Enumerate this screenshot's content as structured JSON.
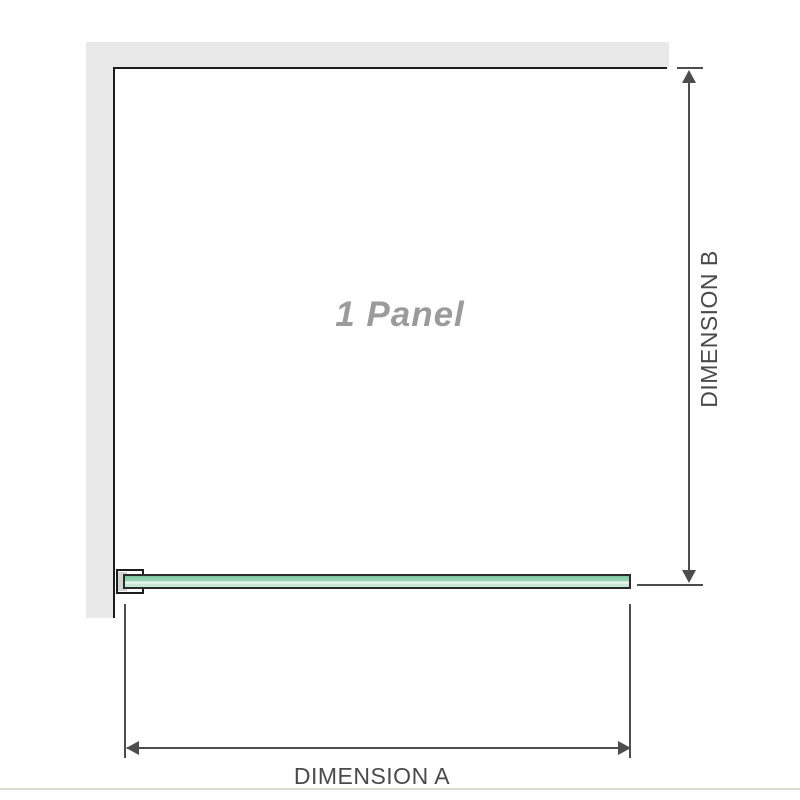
{
  "diagram": {
    "panel_label": "1 Panel",
    "dimension_a_label": "DIMENSION A",
    "dimension_b_label": "DIMENSION B",
    "colors": {
      "wall_fill": "#e9e9e9",
      "panel_outline": "#1c1c1c",
      "dimension_line": "#4d4d4d",
      "dimension_text": "#4a4a4a",
      "panel_label_text": "#9b9b9b",
      "glass_green_dark": "#7fc8a0",
      "glass_green_mid": "#98d4b2",
      "glass_green_highlight": "#e8f6ef",
      "glass_green_light": "#c6e9d4",
      "bracket_inner": "#d4d4d4",
      "footer_line": "#dcdcd2"
    }
  }
}
